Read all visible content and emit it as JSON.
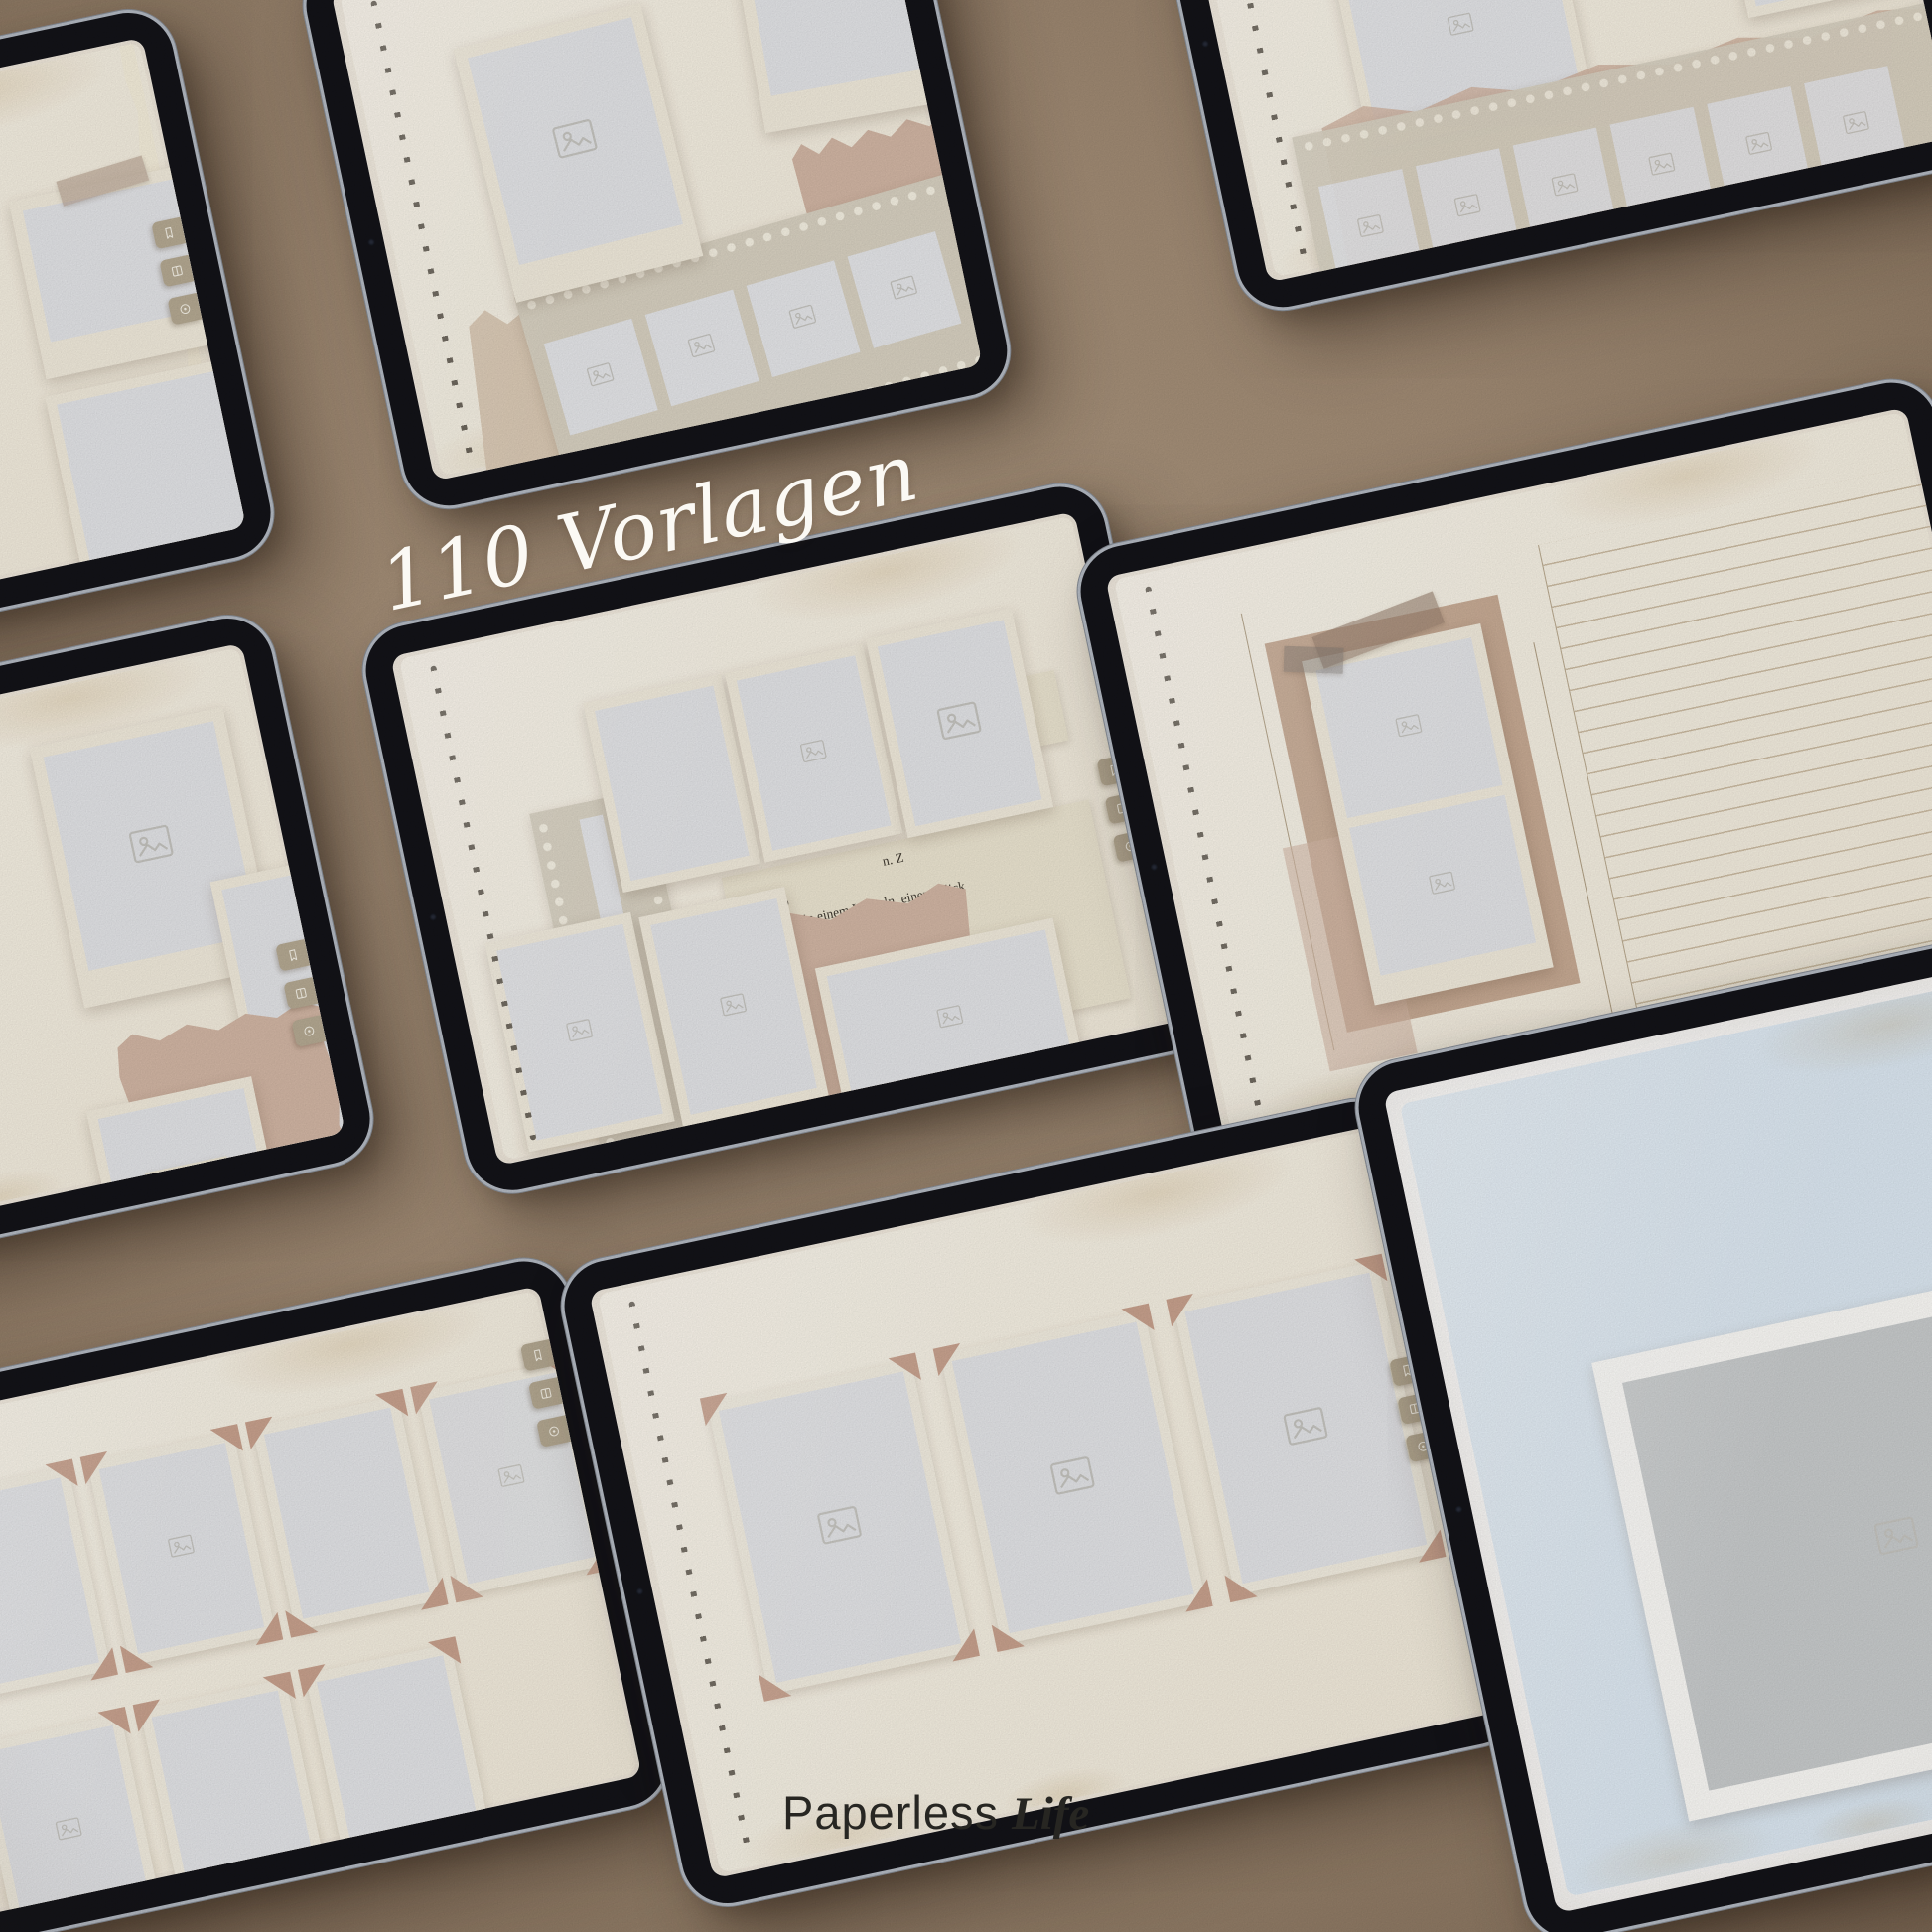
{
  "overlay": {
    "templates_count_label": "110 Vorlagen",
    "brand_regular": "Paperless",
    "brand_italic": "Life"
  },
  "page_watermark": "Paperless life",
  "german_text": {
    "main_scrap_lines": [
      "n. Z",
      "gib",
      "in einem Lächeln, einem Blick",
      "auf der Haut. Fotos bewah",
      "unden, machen Erinnerung",
      "n Geschichten, die sonst",
      "vielleicht verblassen würden. Ein Fotoalbum",
      "mmlung"
    ],
    "right_scrap_lines": [
      "voll ge",
      "lanken u",
      "leicht sein"
    ],
    "left_tablet_scrap_lines": [
      "ll ge",
      "ken u"
    ]
  },
  "tab_icons": [
    "bookmark-icon",
    "pages-icon",
    "lens-icon"
  ],
  "icons": {
    "photo_placeholder": "image-placeholder-icon"
  },
  "colors": {
    "background": "#a28c75",
    "bezel": "#131318",
    "rim": "#b4bac3",
    "page_cream": "#f7f1e4",
    "photo_gray": "#e4e5e8",
    "dusty_rose": "#d3b7a5",
    "corner_rose": "#c9a28e",
    "tan_paper": "#dccbb6",
    "filmstrip": "#d9d2c2",
    "tab": "#b6aa93",
    "ruled_line": "#cdbda4",
    "blue_page": "#dde9f3",
    "overlay_text": "#fbf9f4",
    "brand_text": "#272622"
  },
  "tablets": [
    {
      "id": "top-left",
      "template": "torn-page-photos"
    },
    {
      "id": "top-center",
      "template": "polaroids-filmstrip"
    },
    {
      "id": "top-right",
      "template": "filmstrip-negatives"
    },
    {
      "id": "middle-left",
      "template": "polaroid-collage"
    },
    {
      "id": "center",
      "template": "photo-grid-with-text"
    },
    {
      "id": "middle-right",
      "template": "lined-journal-photo-strip"
    },
    {
      "id": "bottom-left",
      "template": "stamp-frame-grid"
    },
    {
      "id": "bottom-center",
      "template": "three-photos-corner-mounts"
    },
    {
      "id": "bottom-right",
      "template": "blue-matted-photo"
    }
  ]
}
